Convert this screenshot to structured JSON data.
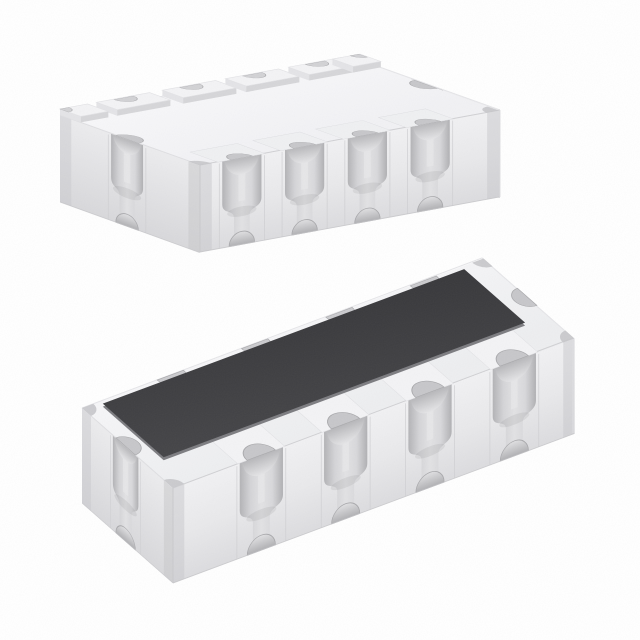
{
  "scene": {
    "subject": "Product photo of two white ceramic resistor-network array chip packages with castellated scalloped terminals; upper chip shown bottom-side up with raised terminal pads, lower chip shown top-side up with a dark rectangular resistive element",
    "background": "#ffffff",
    "palette": {
      "face_top_edge_light": "#e5e5e8",
      "edge_mid": "#d0d0d3",
      "edge_soft": "#dfdfe2",
      "bottom_line": "#c6c6c9",
      "corner_line": "#c9c9cc",
      "groove_light": "#e9e9eb",
      "bowl_rim": "#a8a8ab",
      "notch_fill": "#c7c7ca",
      "back_notch_fill": "#cbcbce",
      "seam": "#cfcfd2",
      "corner_strip": "#c8c8cb",
      "pad_top": "#f3f3f5",
      "pad_side": "#d6d6d9",
      "pad_side_left": "#e4e4e7",
      "pad_side_right": "#dcdcdf",
      "pad_back": "#ebebee",
      "pad_edge": "#e2e2e5",
      "pad_notch": "#d2d2d5",
      "shelf_fill": "#eff0f2",
      "shelf_edge": "#dadade",
      "strip_fill": "#f3f3f5",
      "strip_edge": "#e1e1e4",
      "element_side": "#7d7d81",
      "grad_top_a": [
        "#f8f8fa",
        "#f1f1f4"
      ],
      "grad_top_b": [
        "#f6f6f8",
        "#edeef0"
      ],
      "grad_front": [
        "#f1f1f3",
        "#e9e9eb",
        "#dcdcdf"
      ],
      "grad_end": [
        "#ececee",
        "#d8d8db"
      ],
      "grad_groove": [
        "#b3b3b6",
        "#d4d4d7",
        "#e2e2e4",
        "#d8d8db",
        "#b0b0b3"
      ],
      "grad_bowl": [
        "#b7b7ba",
        "#e5e5e7"
      ],
      "grad_bowl_inv": [
        "#e0e0e2",
        "#b1b1b4"
      ],
      "grad_element": [
        "#454548",
        "#38383b"
      ]
    },
    "chips": [
      {
        "name": "chip-bottom-side-up",
        "origin": [
          60,
          115
        ],
        "u": [
          300,
          -55
        ],
        "v": [
          140,
          50
        ],
        "height": 87,
        "top_gradient": "gTopA",
        "groove_half_width": 20,
        "stem_half_width": 8,
        "notch_radius": 13,
        "groove_fractions": [
          0.14,
          0.35,
          0.56,
          0.77
        ],
        "pad_fractions": [
          0.21,
          0.43,
          0.64,
          0.85
        ],
        "end_groove": {
          "center_f": 0.48,
          "half_width": 17,
          "stem_half": 8,
          "notch_radius": 12
        },
        "corner_strip_width": 12,
        "features": {
          "bottom_pads": true,
          "element": false,
          "front_shelves": true,
          "front_strips": false,
          "back_notches": false
        },
        "pad": {
          "half_len": 27,
          "depth": 22,
          "raise": 6,
          "corner_len": 28,
          "notch_radius": 10
        }
      },
      {
        "name": "chip-top-side-up",
        "origin": [
          82,
          408
        ],
        "u": [
          400,
          -150
        ],
        "v": [
          91,
          80
        ],
        "height": 95,
        "top_gradient": "gTopB",
        "groove_half_width": 23,
        "stem_half_width": 9,
        "notch_radius": 15,
        "groove_fractions": [
          0.22,
          0.43,
          0.64,
          0.85
        ],
        "pad_fractions": [],
        "end_groove": {
          "center_f": 0.48,
          "half_width": 17,
          "stem_half": 8,
          "notch_radius": 13
        },
        "corner_strip_width": 12,
        "features": {
          "bottom_pads": false,
          "element": true,
          "front_shelves": false,
          "front_strips": true,
          "back_notches": true
        },
        "element": {
          "s0f": 0.045,
          "s1f": 0.945,
          "t0f": 0.03,
          "t1f": 0.7,
          "side_offset": 3
        }
      }
    ]
  }
}
